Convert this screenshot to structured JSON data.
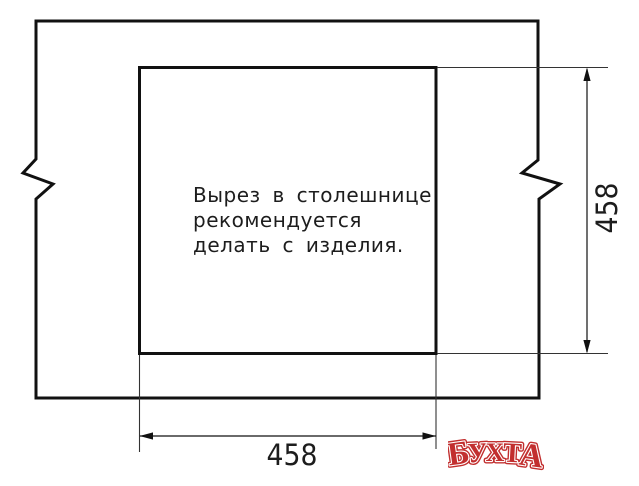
{
  "note": {
    "lines": [
      "Вырез в столешнице",
      "рекомендуется",
      "делать с изделия."
    ]
  },
  "dimensions": {
    "cutout_width": "458",
    "cutout_height": "458"
  },
  "logo": {
    "text": "БУХТА",
    "letters": [
      "Б",
      "У",
      "Х",
      "Т",
      "А"
    ],
    "color": "#c22f2f"
  }
}
